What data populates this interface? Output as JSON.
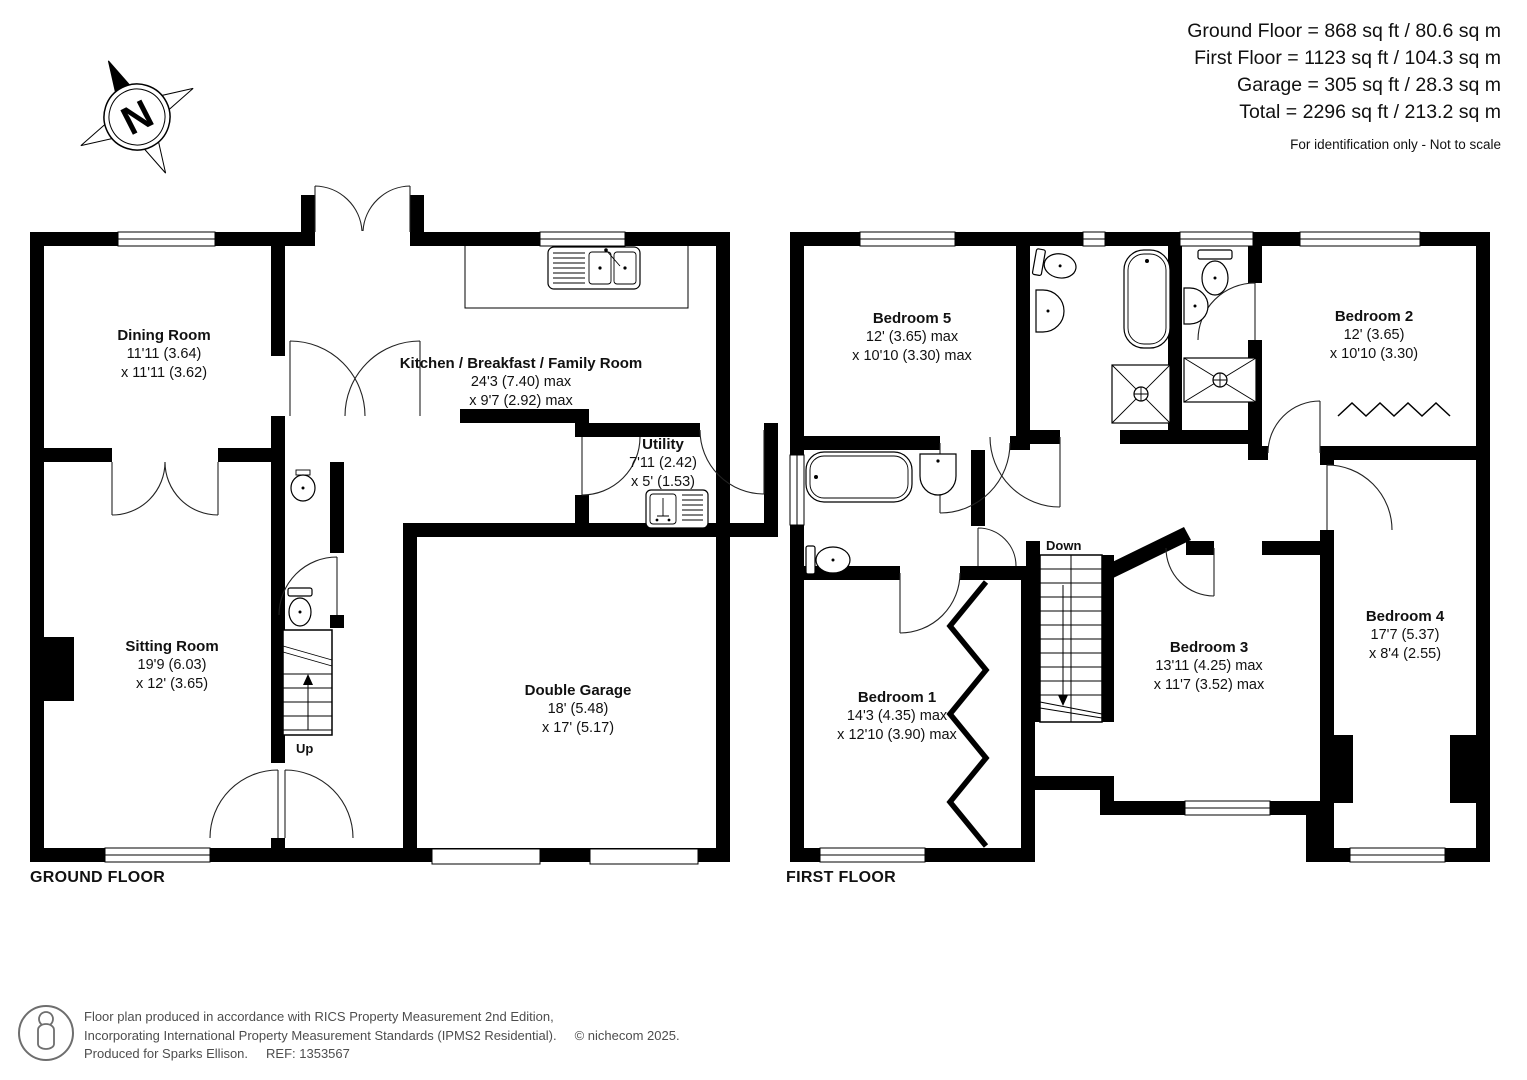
{
  "header": {
    "area_summary": [
      "Ground Floor = 868 sq ft / 80.6 sq m",
      "First Floor = 1123 sq ft / 104.3 sq m",
      "Garage = 305 sq ft / 28.3 sq m",
      "Total = 2296 sq ft / 213.2 sq m"
    ],
    "disclaimer": "For identification only - Not to scale"
  },
  "compass": {
    "north_label": "N"
  },
  "ground_floor": {
    "title": "GROUND FLOOR",
    "stairs_label": "Up",
    "dining": {
      "name": "Dining Room",
      "dim1": "11'11 (3.64)",
      "dim2": "x 11'11 (3.62)"
    },
    "kitchen": {
      "name": "Kitchen / Breakfast / Family Room",
      "dim1": "24'3 (7.40) max",
      "dim2": "x 9'7 (2.92) max"
    },
    "utility": {
      "name": "Utility",
      "dim1": "7'11 (2.42)",
      "dim2": "x 5' (1.53)"
    },
    "sitting": {
      "name": "Sitting Room",
      "dim1": "19'9 (6.03)",
      "dim2": "x 12' (3.65)"
    },
    "garage": {
      "name": "Double Garage",
      "dim1": "18' (5.48)",
      "dim2": "x 17' (5.17)"
    }
  },
  "first_floor": {
    "title": "FIRST FLOOR",
    "stairs_label": "Down",
    "bedroom1": {
      "name": "Bedroom 1",
      "dim1": "14'3 (4.35) max",
      "dim2": "x 12'10 (3.90) max"
    },
    "bedroom2": {
      "name": "Bedroom 2",
      "dim1": "12' (3.65)",
      "dim2": "x 10'10 (3.30)"
    },
    "bedroom3": {
      "name": "Bedroom 3",
      "dim1": "13'11 (4.25) max",
      "dim2": "x 11'7 (3.52) max"
    },
    "bedroom4": {
      "name": "Bedroom 4",
      "dim1": "17'7 (5.37)",
      "dim2": "x 8'4 (2.55)"
    },
    "bedroom5": {
      "name": "Bedroom 5",
      "dim1": "12' (3.65) max",
      "dim2": "x 10'10 (3.30) max"
    }
  },
  "footer": {
    "line1": "Floor plan produced in accordance with RICS Property Measurement 2nd Edition,",
    "line2": "Incorporating International Property Measurement Standards (IPMS2 Residential).",
    "copyright": "© nichecom 2025.",
    "line3": "Produced for Sparks Ellison.",
    "ref": "REF: 1353567"
  },
  "colors": {
    "wall": "#000000",
    "text": "#111111",
    "footer_text": "#4d4d4d"
  }
}
